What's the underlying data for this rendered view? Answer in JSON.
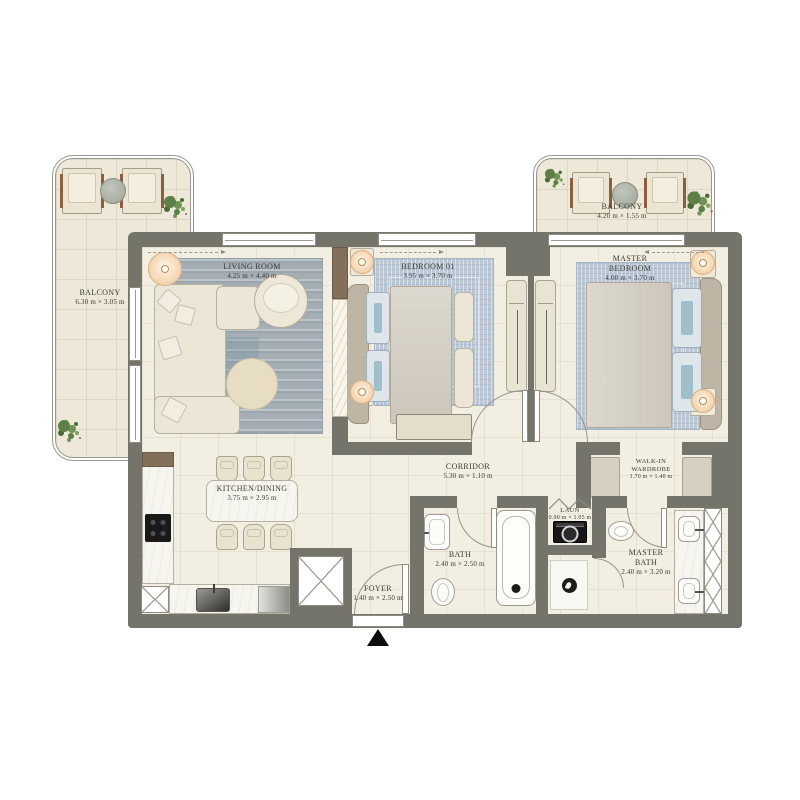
{
  "rooms": {
    "balcony_left": {
      "name": "BALCONY",
      "dims": "6.30 m × 3.05 m"
    },
    "living_room": {
      "name": "LIVING ROOM",
      "dims": "4.25 m × 4.40 m"
    },
    "bedroom_01": {
      "name": "BEDROOM 01",
      "dims": "3.95 m × 3.70 m"
    },
    "balcony_right": {
      "name": "BALCONY",
      "dims": "4.20 m × 1.55 m"
    },
    "master_bedroom": {
      "name": "MASTER BEDROOM",
      "dims": "4.00 m × 3.70 m"
    },
    "kitchen_dining": {
      "name": "KITCHEN/DINING",
      "dims": "3.75 m × 2.95 m"
    },
    "corridor": {
      "name": "CORRIDOR",
      "dims": "5.30 m × 1.10 m"
    },
    "walk_in_wardrobe": {
      "name": "WALK-IN WARDROBE",
      "dims": "1.70 m × 1.40 m"
    },
    "bath": {
      "name": "BATH",
      "dims": "2.40 m × 2.50 m"
    },
    "laundry": {
      "name": "LAUN",
      "dims": "0.90 m × 1.05 m"
    },
    "master_bath": {
      "name": "MASTER BATH",
      "dims": "2.40 m × 3.20 m"
    },
    "foyer": {
      "name": "FOYER",
      "dims": "1.40 m × 2.50 m"
    }
  },
  "colors": {
    "background": "#ffffff",
    "wall": "#74746a",
    "floor": "#f2eee1",
    "balcony_floor": "#eee8d8",
    "living_rug": "#a4aeb4",
    "bedroom_rug": "#bcc7d4",
    "furniture_cream": "#ebe6d5",
    "wood": "#83705a",
    "plant_green": "#5d8046",
    "lamp_glow": "#f3d3ac",
    "label_text": "#3b3b31"
  },
  "icons": {
    "entrance_marker": "entrance-arrow-icon",
    "shaft": "shaft-x-icon",
    "drain": "shower-drain-icon",
    "cooktop": "cooktop-icon",
    "washer": "washing-machine-icon"
  }
}
